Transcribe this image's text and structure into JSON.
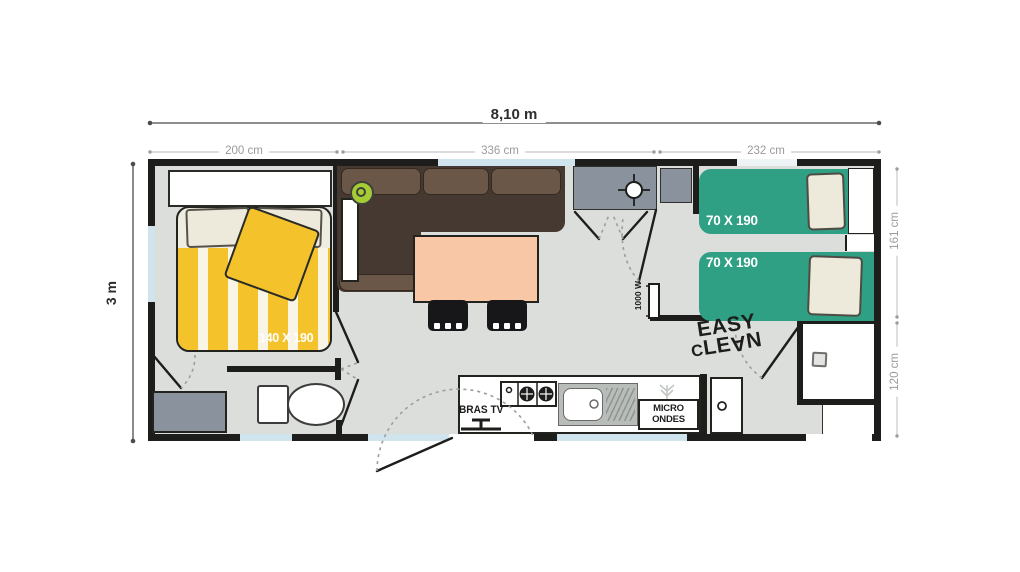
{
  "dimensions": {
    "total_width": "8,10 m",
    "total_height": "3 m",
    "top_segments": [
      "200 cm",
      "336 cm",
      "232 cm"
    ],
    "right_segments": [
      "161 cm",
      "120 cm"
    ]
  },
  "rooms": {
    "master_bedroom": {
      "bed_size": "140 X 190"
    },
    "twin_bedroom": {
      "bed1_size": "70 X 190",
      "bed2_size": "70 X 190"
    },
    "living_area": {
      "heater_power": "1000 W"
    },
    "kitchen": {
      "tv_bracket": "BRAS TV",
      "microwave_line1": "MICRO",
      "microwave_line2": "ONDES"
    },
    "shower_room": {
      "logo_line1": "EASY",
      "logo_line2": "CLEAN"
    }
  },
  "icons": {
    "plant": "round potted plant, top view",
    "ceiling_light": "crosshair lamp symbol in wardrobe",
    "sprig": "gray sprig above microwave",
    "drain": "square shower drain",
    "tv_mount": "TV bracket, top view",
    "door_handle": "round knob on tall cupboard door"
  },
  "colors": {
    "wall": "#1d1d1b",
    "floor": "#dcdedc",
    "window": "#cfe4ed",
    "sofa_dark": "#463931",
    "sofa_light": "#6b5748",
    "table_peach": "#f8c7a5",
    "bed_yellow": "#f4c32b",
    "cream": "#efece1",
    "pillow_cream": "#edeadb",
    "twin_green": "#2fa084",
    "unit_gray": "#8a929d",
    "sink_gray": "#b9bdb9",
    "dim_gray": "#9b9b9b",
    "dim_dark": "#3a3a38"
  }
}
